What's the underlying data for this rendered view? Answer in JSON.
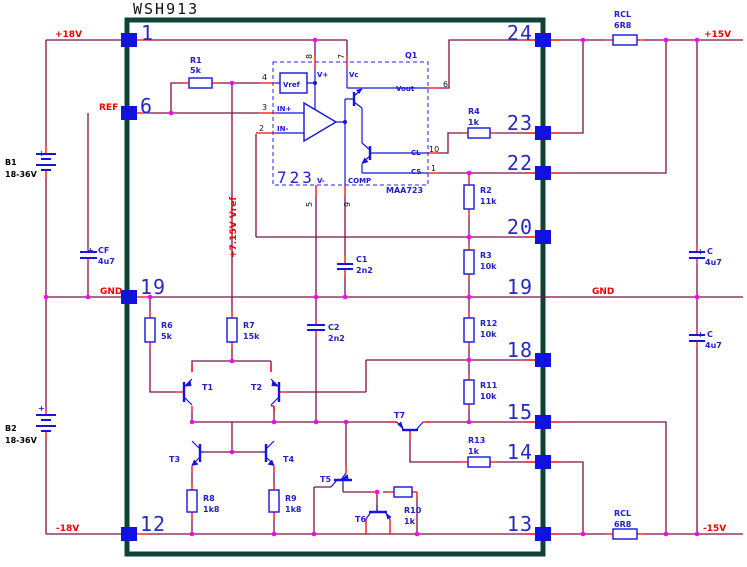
{
  "title": "WSH913",
  "labels": {
    "p18v": "+18V",
    "n18v": "-18V",
    "p15v": "+15V",
    "n15v": "-15V",
    "gnd_left": "GND",
    "gnd_right": "GND",
    "ref": "REF",
    "vref_rail": "+7.15V Vref"
  },
  "module_pins": {
    "left": [
      "1",
      "6",
      "19",
      "12"
    ],
    "right": [
      "24",
      "23",
      "22",
      "20",
      "19",
      "18",
      "15",
      "14",
      "13"
    ]
  },
  "ic": {
    "label": "723",
    "part": "MAA723",
    "designator": "Q1",
    "vref_box": "Vref",
    "pin_names": {
      "vplus": "V+",
      "vc": "Vc",
      "vout": "Vout",
      "cl": "CL",
      "cs": "CS",
      "vminus": "V-",
      "comp": "COMP",
      "inp": "IN+",
      "inn": "IN-"
    },
    "pin_nums": {
      "p4": "4",
      "p3": "3",
      "p2": "2",
      "p8": "8",
      "p7": "7",
      "p6": "6",
      "p10": "10",
      "p1": "1",
      "p5": "5",
      "p9": "9"
    }
  },
  "resistors": [
    {
      "name": "R1",
      "value": "5k"
    },
    {
      "name": "R4",
      "value": "1k"
    },
    {
      "name": "R2",
      "value": "11k"
    },
    {
      "name": "R3",
      "value": "10k"
    },
    {
      "name": "R12",
      "value": "10k"
    },
    {
      "name": "R11",
      "value": "10k"
    },
    {
      "name": "R13",
      "value": "1k"
    },
    {
      "name": "R6",
      "value": "5k"
    },
    {
      "name": "R7",
      "value": "15k"
    },
    {
      "name": "R8",
      "value": "1k8"
    },
    {
      "name": "R9",
      "value": "1k8"
    },
    {
      "name": "R10",
      "value": "1k"
    },
    {
      "name": "RCL",
      "value": "6R8"
    },
    {
      "name": "RCL",
      "value": "6R8"
    }
  ],
  "capacitors": [
    {
      "name": "CF",
      "value": "4u7",
      "plus": "+"
    },
    {
      "name": "C",
      "value": "4u7",
      "plus": "+"
    },
    {
      "name": "C",
      "value": "4u7",
      "plus": "+"
    },
    {
      "name": "C1",
      "value": "2n2"
    },
    {
      "name": "C2",
      "value": "2n2"
    }
  ],
  "batteries": [
    {
      "name": "B1",
      "value": "18-36V",
      "plus": "+"
    },
    {
      "name": "B2",
      "value": "18-36V",
      "plus": "+"
    }
  ],
  "transistors": [
    "T1",
    "T2",
    "T3",
    "T4",
    "T5",
    "T6",
    "T7"
  ]
}
